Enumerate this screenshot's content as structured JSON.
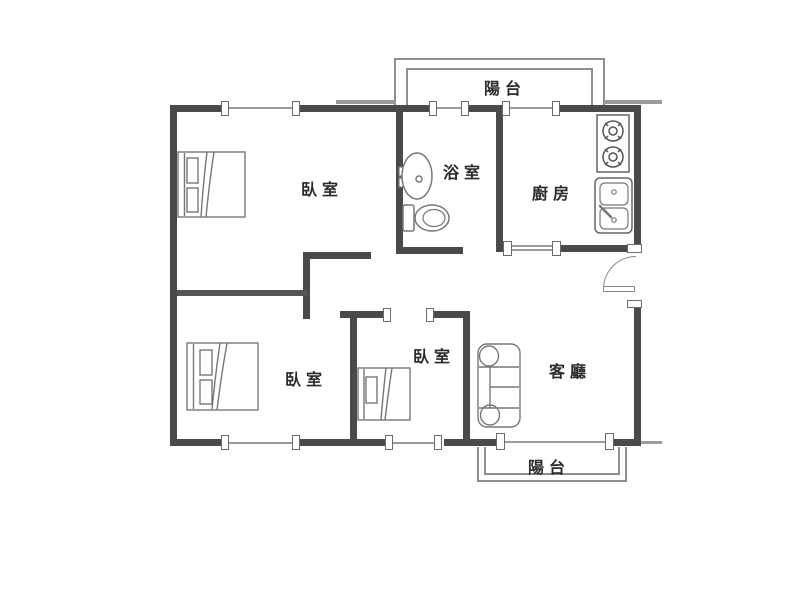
{
  "floorplan": {
    "rooms": {
      "balcony_top": {
        "label": "陽台"
      },
      "bedroom_master": {
        "label": "臥室"
      },
      "bathroom": {
        "label": "浴室"
      },
      "kitchen": {
        "label": "廚房"
      },
      "bedroom_second": {
        "label": "臥室"
      },
      "bedroom_small": {
        "label": "臥室"
      },
      "living_room": {
        "label": "客廳"
      },
      "balcony_bottom": {
        "label": "陽台"
      }
    },
    "fixtures": [
      "double-bed-master",
      "double-bed-second",
      "single-bed-small",
      "sofa",
      "washbasin",
      "toilet",
      "stove-two-burner",
      "double-basin-sink",
      "entry-door-swing"
    ],
    "colors": {
      "wall": "#4a4a4a",
      "window_line": "#9b9b9b",
      "parapet_line": "#8e8e8e",
      "furniture_line": "#777777",
      "text": "#2b2b2b",
      "background": "#ffffff"
    }
  }
}
